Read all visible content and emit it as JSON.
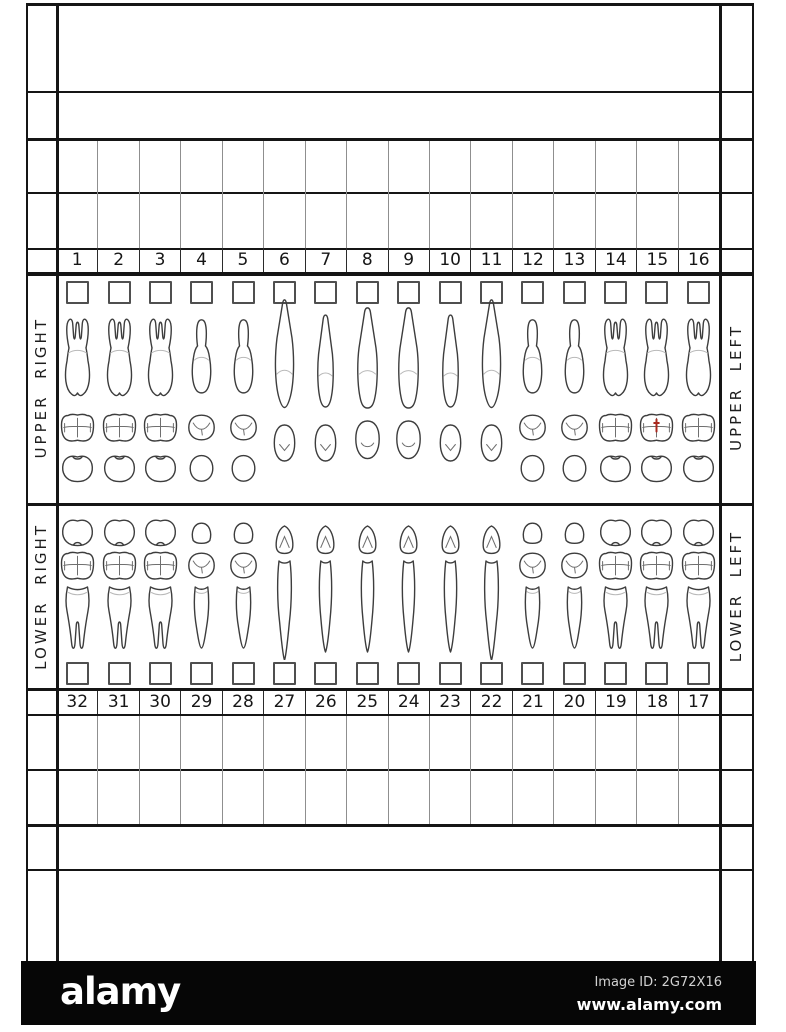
{
  "document": {
    "title": "dental tooth chart form",
    "line_color": "#151515",
    "side_labels": {
      "upper_right": "UPPER  RIGHT",
      "upper_left": "UPPER  LEFT",
      "lower_right": "LOWER  RIGHT",
      "lower_left": "LOWER  LEFT"
    },
    "upper_teeth": [
      {
        "num": "1",
        "type": "molar"
      },
      {
        "num": "2",
        "type": "molar"
      },
      {
        "num": "3",
        "type": "molar"
      },
      {
        "num": "4",
        "type": "premolar"
      },
      {
        "num": "5",
        "type": "premolar"
      },
      {
        "num": "6",
        "type": "canine"
      },
      {
        "num": "7",
        "type": "incisor"
      },
      {
        "num": "8",
        "type": "central"
      },
      {
        "num": "9",
        "type": "central"
      },
      {
        "num": "10",
        "type": "incisor"
      },
      {
        "num": "11",
        "type": "canine"
      },
      {
        "num": "12",
        "type": "premolar"
      },
      {
        "num": "13",
        "type": "premolar"
      },
      {
        "num": "14",
        "type": "molar"
      },
      {
        "num": "15",
        "type": "molar",
        "mark": "red-line"
      },
      {
        "num": "16",
        "type": "molar"
      }
    ],
    "lower_teeth": [
      {
        "num": "32",
        "type": "molar"
      },
      {
        "num": "31",
        "type": "molar"
      },
      {
        "num": "30",
        "type": "molar"
      },
      {
        "num": "29",
        "type": "premolar"
      },
      {
        "num": "28",
        "type": "premolar"
      },
      {
        "num": "27",
        "type": "canine"
      },
      {
        "num": "26",
        "type": "incisor"
      },
      {
        "num": "25",
        "type": "incisor"
      },
      {
        "num": "24",
        "type": "incisor"
      },
      {
        "num": "23",
        "type": "incisor"
      },
      {
        "num": "22",
        "type": "canine"
      },
      {
        "num": "21",
        "type": "premolar"
      },
      {
        "num": "20",
        "type": "premolar"
      },
      {
        "num": "19",
        "type": "molar"
      },
      {
        "num": "18",
        "type": "molar"
      },
      {
        "num": "17",
        "type": "molar"
      }
    ],
    "checkboxes_checked": "none",
    "mark_color": "#a8281e"
  },
  "footer": {
    "logo": "alamy",
    "image_id": "Image ID: 2G72X16",
    "website": "www.alamy.com",
    "bg": "#000000"
  }
}
